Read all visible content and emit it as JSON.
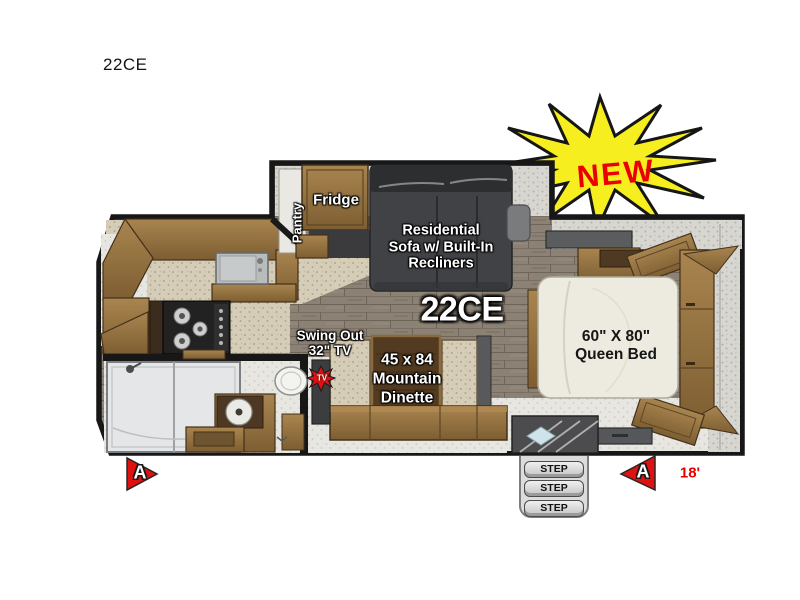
{
  "title": "22CE",
  "badge": {
    "text": "NEW"
  },
  "plan": {
    "model": "22CE",
    "pantry": "Pantry",
    "fridge": "Fridge",
    "sofa_lines": [
      "Residential",
      "Sofa w/ Built-In",
      "Recliners"
    ],
    "tv_lines": [
      "Swing Out",
      "32\" TV"
    ],
    "tv_badge": "TV",
    "dinette_lines": [
      "45 x 84",
      "Mountain",
      "Dinette"
    ],
    "bed_lines": [
      "60\" X 80\"",
      "Queen Bed"
    ],
    "steps": [
      "STEP",
      "STEP",
      "STEP"
    ],
    "marker_left": "A",
    "marker_right": "A",
    "length": "18'"
  },
  "colors": {
    "burst_yellow": "#f6ee1f",
    "accent_red": "#ea0000",
    "wood": "#8a6a3e",
    "sofa_gray": "#414245",
    "floor": "#8b8174"
  }
}
